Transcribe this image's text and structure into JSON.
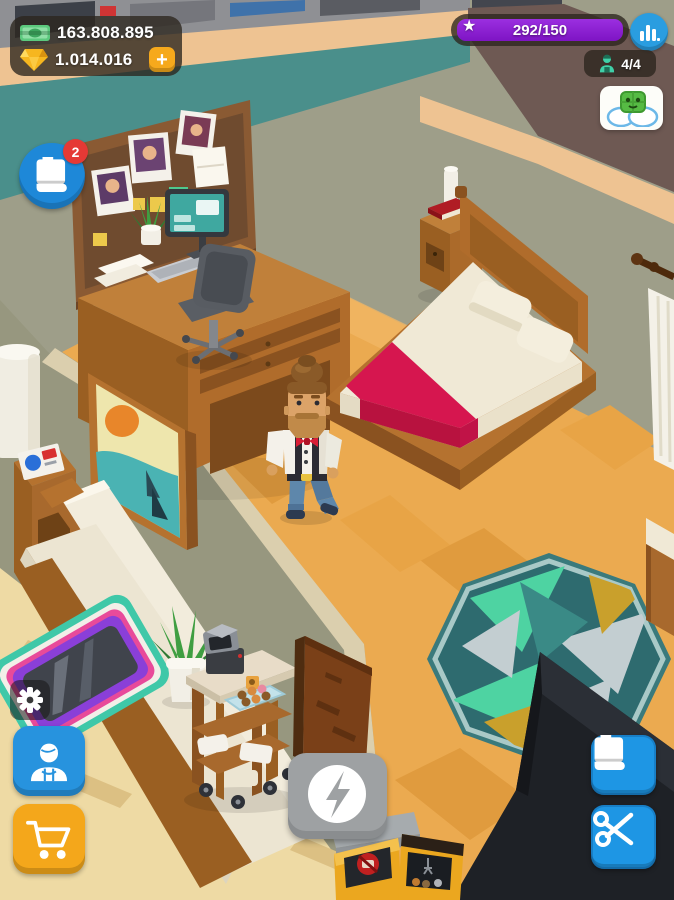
{
  "hud": {
    "money": {
      "value": "163.808.895"
    },
    "gems": {
      "value": "1.014.016",
      "add_label": "+"
    },
    "level": {
      "progress": "292/150"
    },
    "staff": {
      "count": "4/4"
    },
    "tasks": {
      "badge": "2"
    }
  },
  "icons": {
    "money": "cash-bill-icon",
    "gems": "gem-icon",
    "gems_add": "plus-icon",
    "level": "star-icon",
    "stats": "bar-chart-icon",
    "staff": "worker-icon",
    "chat": "mascot-chat-bubbles-icon",
    "tasks": "book-icon",
    "settings": "gear-icon",
    "barbers": "barber-person-icon",
    "shop": "shopping-cart-icon",
    "boost": "lightning-icon",
    "journal": "book-icon",
    "tools": "scissors-icon"
  },
  "colors": {
    "hud_panel": "rgba(44,37,29,0.78)",
    "accent_blue": "#2793de",
    "accent_orange": "#f4a71b",
    "progress_purple": "#8d1fd6",
    "badge_red": "#e53935",
    "boost_gray": "#9ea1a3",
    "wall_olive": "#9e9e89",
    "band_teal": "#4a8f8b",
    "band_tan": "#eec392",
    "band_mauve": "#6e5953",
    "floor_orange": "#ebaa50",
    "floor_wood_light": "#eedaa4",
    "bed_blanket": "#d6164f",
    "rug_field": "#2e6b6f",
    "counter_black": "#1e2126"
  },
  "scene": {
    "objects": [
      "corkboard-with-photos",
      "desk-with-computer",
      "office-chair",
      "potted-desk-plant",
      "double-bed",
      "red-blanket",
      "pillows",
      "nightstand",
      "table-lamp",
      "red-book",
      "walking-owner-character",
      "wall-painting",
      "white-column",
      "side-table",
      "magazine",
      "sofa",
      "barber-mirror-station",
      "floor-plant",
      "service-cart",
      "coffee-machine",
      "donut-tray",
      "wooden-door",
      "area-rug",
      "black-counter",
      "arcade-machines",
      "curtain-with-rod"
    ]
  }
}
